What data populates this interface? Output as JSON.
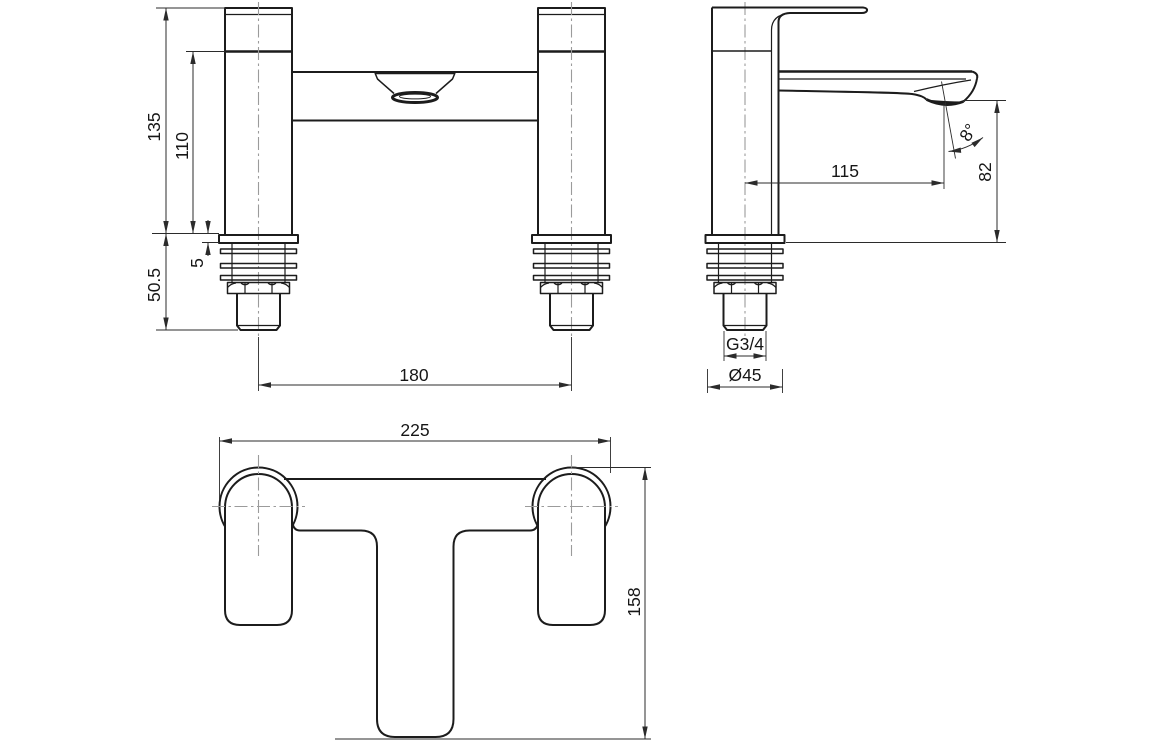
{
  "colors": {
    "background": "#ffffff",
    "outline": "#1c1c1c",
    "dimension": "#2b2b2b",
    "centerline": "#9b9b9b",
    "label": "#161616"
  },
  "views": {
    "front": {
      "dims": {
        "overall_height": "135",
        "body_height": "110",
        "flange_thickness": "5",
        "base_height": "50.5",
        "pillar_centres": "180"
      }
    },
    "side": {
      "dims": {
        "spout_reach": "115",
        "outlet_height": "82",
        "outlet_angle": "8°",
        "thread_size": "G3/4",
        "flange_diameter": "Ø45"
      }
    },
    "plan": {
      "dims": {
        "overall_width": "225",
        "overall_depth": "158"
      }
    }
  }
}
